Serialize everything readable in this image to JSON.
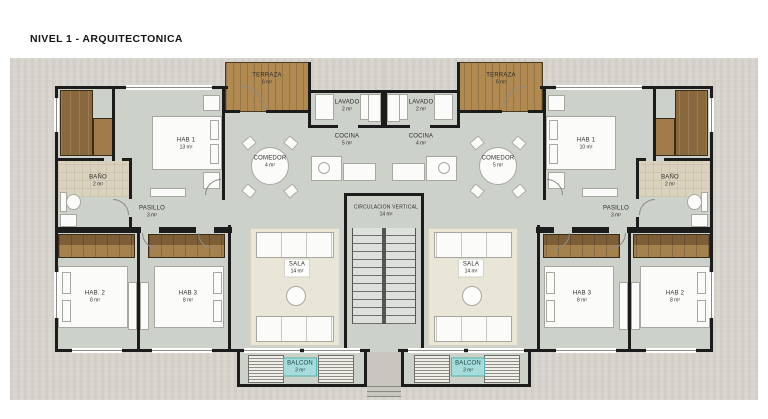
{
  "title": "NIVEL 1 - ARQUITECTONICA",
  "colors": {
    "wall": "#1c1c1c",
    "floor": "#ccd1ca",
    "ground": "#d8d4cd",
    "wood_deck": "#b18a52",
    "balcon_label_bg": "#a6dcdb"
  },
  "plan": {
    "shared": {
      "circulacion": {
        "name": "CIRCULACION VERTICAL",
        "area": "14 m²"
      }
    },
    "unit_left": {
      "terraza": {
        "name": "TERRAZA",
        "area": "6 m²"
      },
      "lavado": {
        "name": "LAVADO",
        "area": "2 m²"
      },
      "cocina": {
        "name": "COCINA",
        "area": "5 m²"
      },
      "comedor": {
        "name": "COMEDOR",
        "area": "4 m²"
      },
      "hab1": {
        "name": "HAB 1",
        "area": "13 m²"
      },
      "bano": {
        "name": "BAÑO",
        "area": "2 m²"
      },
      "pasillo": {
        "name": "PASILLO",
        "area": "3 m²"
      },
      "hab2": {
        "name": "HAB. 2",
        "area": "8 m²"
      },
      "hab3": {
        "name": "HAB 3",
        "area": "8 m²"
      },
      "sala": {
        "name": "SALA",
        "area": "14 m²"
      },
      "balcon": {
        "name": "BALCON",
        "area": "3 m²"
      }
    },
    "unit_right": {
      "terraza": {
        "name": "TERRAZA",
        "area": "6 m²"
      },
      "lavado": {
        "name": "LAVADO",
        "area": "2 m²"
      },
      "cocina": {
        "name": "COCINA",
        "area": "4 m²"
      },
      "comedor": {
        "name": "COMEDOR",
        "area": "5 m²"
      },
      "hab1": {
        "name": "HAB 1",
        "area": "10 m²"
      },
      "bano": {
        "name": "BAÑO",
        "area": "2 m²"
      },
      "pasillo": {
        "name": "PASILLO",
        "area": "3 m²"
      },
      "hab3": {
        "name": "HAB 3",
        "area": "8 m²"
      },
      "hab2": {
        "name": "HAB 2",
        "area": "8 m²"
      },
      "sala": {
        "name": "SALA",
        "area": "14 m²"
      },
      "balcon": {
        "name": "BALCON",
        "area": "3 m²"
      }
    }
  }
}
